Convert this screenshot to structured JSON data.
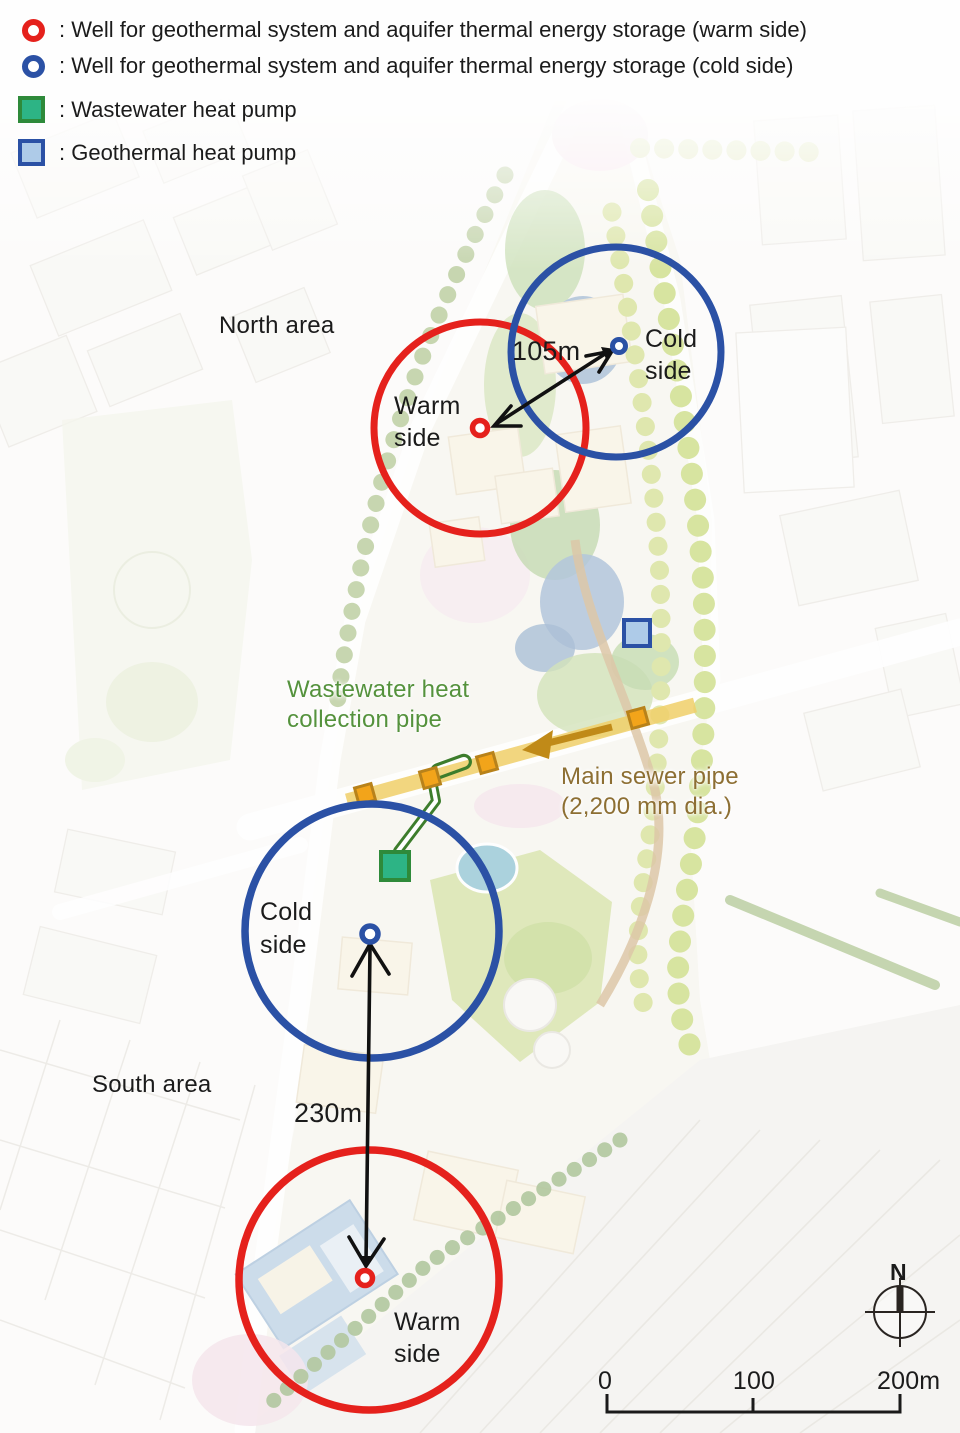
{
  "legend": {
    "items": [
      {
        "icon": "warm-well-icon",
        "label": ": Well for geothermal system and aquifer thermal energy storage (warm side)"
      },
      {
        "icon": "cold-well-icon",
        "label": ": Well for geothermal system and aquifer thermal energy storage (cold side)"
      },
      {
        "icon": "wastewater-heat-pump-icon",
        "label": ": Wastewater heat pump"
      },
      {
        "icon": "geothermal-heat-pump-icon",
        "label": ": Geothermal heat pump"
      }
    ]
  },
  "map": {
    "areas": {
      "north": "North area",
      "south": "South area"
    },
    "wells": {
      "north_warm": {
        "line1": "Warm",
        "line2": "side"
      },
      "north_cold": {
        "line1": "Cold",
        "line2": "side"
      },
      "south_cold": {
        "line1": "Cold",
        "line2": "side"
      },
      "south_warm": {
        "line1": "Warm",
        "line2": "side"
      }
    },
    "distances": {
      "north_wells": "105m",
      "south_wells": "230m"
    },
    "pipes": {
      "wastewater_line1": "Wastewater heat",
      "wastewater_line2": "collection pipe",
      "sewer_line1": "Main sewer pipe",
      "sewer_line2": "(2,200 mm dia.)"
    }
  },
  "compass": {
    "north_label": "N"
  },
  "scale_bar": {
    "tick_labels": [
      "0",
      "100",
      "200m"
    ]
  },
  "colors": {
    "warm": "#e5211c",
    "cold": "#2b51a5",
    "wastewater_pump_fill": "#2db485",
    "wastewater_pump_stroke": "#2e8a3a",
    "geothermal_pump_fill": "#aecbe8",
    "sewer_band": "#f1d06a",
    "sewer_square_fill": "#f2a41a",
    "sewer_square_stroke": "#b8821a",
    "sewer_arrow": "#c08a18",
    "sewer_text": "#8d6f33",
    "wastewater_text": "#55923d",
    "wastewater_pipe": "#3d7d2c"
  }
}
